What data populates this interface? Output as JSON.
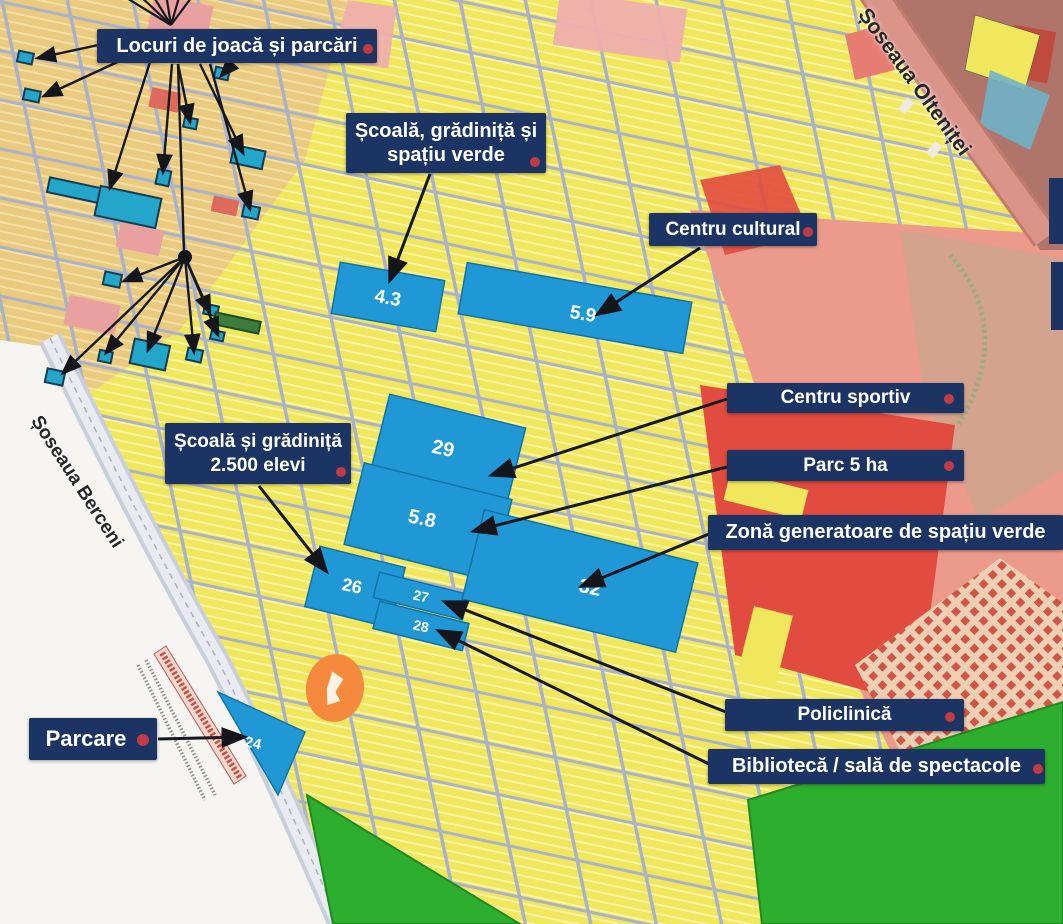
{
  "annotations": {
    "playgrounds": "Locuri de joacă și parcări",
    "school_green_l1": "Școală, grădiniță și",
    "school_green_l2": "spațiu verde",
    "cultural": "Centru cultural",
    "sports": "Centru sportiv",
    "park": "Parc 5 ha",
    "green_zone": "Zonă generatoare de spațiu verde",
    "school_l1": "Școală și grădiniță",
    "school_l2": "2.500 elevi",
    "polyclinic": "Policlinică",
    "library": "Bibliotecă / sală de spectacole",
    "parking": "Parcare"
  },
  "roads": {
    "oltenitei": "Șoseaua Olteniței",
    "berceni": "Șoseaua Berceni"
  },
  "parcels": {
    "p43": "4.3",
    "p59": "5.9",
    "p29": "29",
    "p58": "5.8",
    "p26": "26",
    "p27": "27",
    "p28": "28",
    "p32": "32",
    "p24": "24"
  },
  "colors": {
    "label_bg": "#1c3463",
    "label_text": "#ffffff",
    "marker_dot": "#c13b45",
    "parcel_blue": "#1f98d5",
    "marker_teal": "#23a6c9",
    "zone_yellow": "#f1e75d",
    "zone_salmon": "#eb9a8b",
    "zone_red": "#e24b3f",
    "zone_green": "#2eae2e",
    "blob_orange": "#f58a3c",
    "street_gray": "#a9b2c8"
  }
}
